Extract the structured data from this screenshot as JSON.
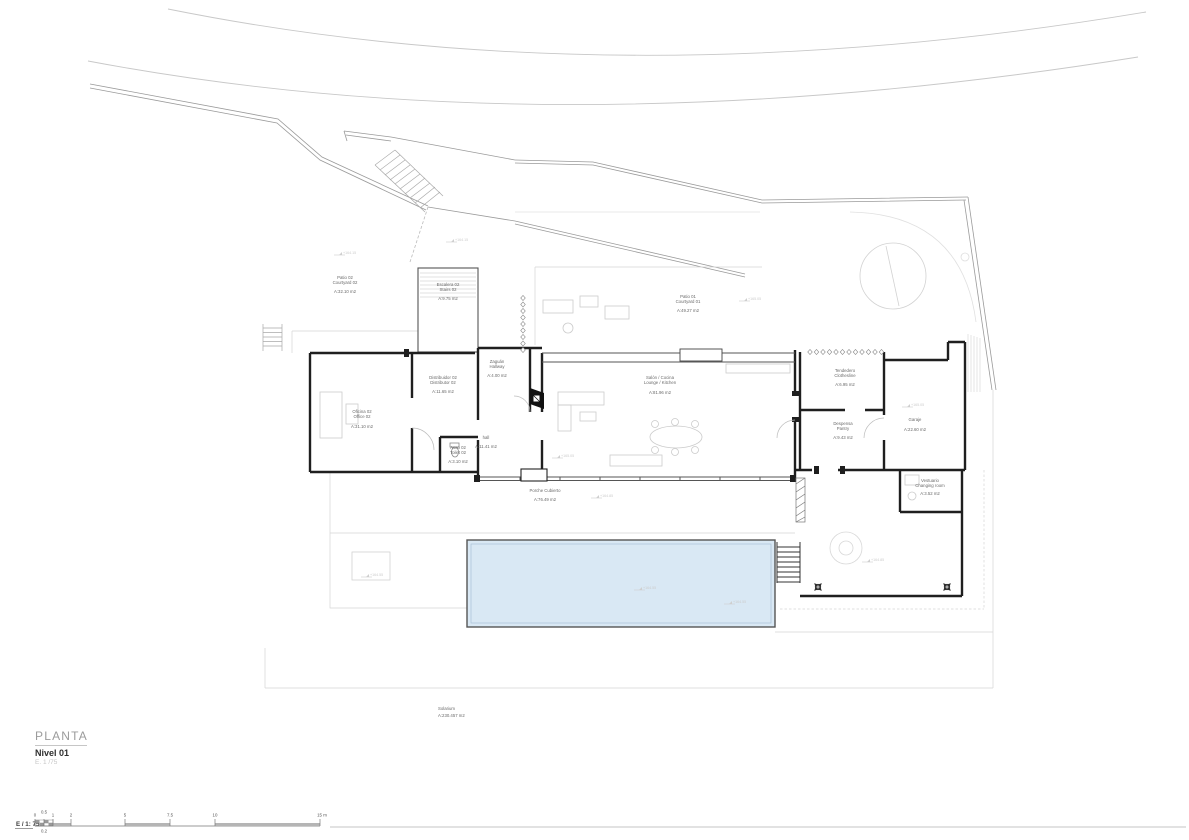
{
  "title_block": {
    "series": "PLANTA",
    "level": "Nivel 01",
    "scale": "E. 1 /75"
  },
  "scale_bar": {
    "label": "E / 1: 75",
    "ticks": [
      "0",
      "0.5",
      "1",
      "2",
      "5",
      "7.5",
      "10",
      "15 m"
    ],
    "sub_label": "0.2"
  },
  "rooms": [
    {
      "id": "patio-02",
      "name_es": "Patio 02",
      "name_en": "Courtyard 02",
      "area": "A:32.10 m2"
    },
    {
      "id": "escalera-02",
      "name_es": "Escalera 02",
      "name_en": "Stairs 02",
      "area": "A:9.75 m2"
    },
    {
      "id": "patio-01",
      "name_es": "Patio 01",
      "name_en": "Courtyard 01",
      "area": "A:49.27 m2"
    },
    {
      "id": "zaguan",
      "name_es": "Zaguán",
      "name_en": "Hallway",
      "area": "A:4.00 m2"
    },
    {
      "id": "distribuidor-02",
      "name_es": "Distribuidor 02",
      "name_en": "Distributor 02",
      "area": "A:11.65 m2"
    },
    {
      "id": "salon-cocina",
      "name_es": "Salón / Cocina",
      "name_en": "Lounge / Kitchen",
      "area": "A:81.96 m2"
    },
    {
      "id": "tendedero",
      "name_es": "Tendedero",
      "name_en": "Clothesline",
      "area": "A:6.95 m2"
    },
    {
      "id": "oficina-02",
      "name_es": "Oficina 02",
      "name_en": "Office 02",
      "area": "A:31.10 m2"
    },
    {
      "id": "garaje",
      "name_es": "Garaje",
      "name_en": "",
      "area": "A:22.60 m2"
    },
    {
      "id": "despensa",
      "name_es": "Despensa",
      "name_en": "Pantry",
      "area": "A:9.43 m2"
    },
    {
      "id": "hall",
      "name_es": "hall",
      "name_en": "",
      "area": "A:11.41 m2"
    },
    {
      "id": "aseo-02",
      "name_es": "Aseo 02",
      "name_en": "Toilet 02",
      "area": "A:3.10 m2"
    },
    {
      "id": "vestuario",
      "name_es": "Vestuario",
      "name_en": "Changing room",
      "area": "A:3.52 m2"
    },
    {
      "id": "porche",
      "name_es": "Porche Cubierto",
      "name_en": "",
      "area": "A:76.49 m2"
    },
    {
      "id": "solarium",
      "name_es": "Solarium",
      "name_en": "",
      "area": "A:230.457 m2"
    }
  ],
  "level_markers": [
    {
      "label": "+164.15"
    },
    {
      "label": "+164.15"
    },
    {
      "label": "+165.05"
    },
    {
      "label": "+165.05"
    },
    {
      "label": "+165.05"
    },
    {
      "label": "+164.85"
    },
    {
      "label": "+164.55"
    },
    {
      "label": "+164.55"
    },
    {
      "label": "+164.55"
    },
    {
      "label": "+164.85"
    }
  ],
  "colors": {
    "wall": "#1f1f1f",
    "pool_fill": "#d9e8f4",
    "light_line": "#c9c9c9",
    "label_text": "#6a6a6a"
  }
}
